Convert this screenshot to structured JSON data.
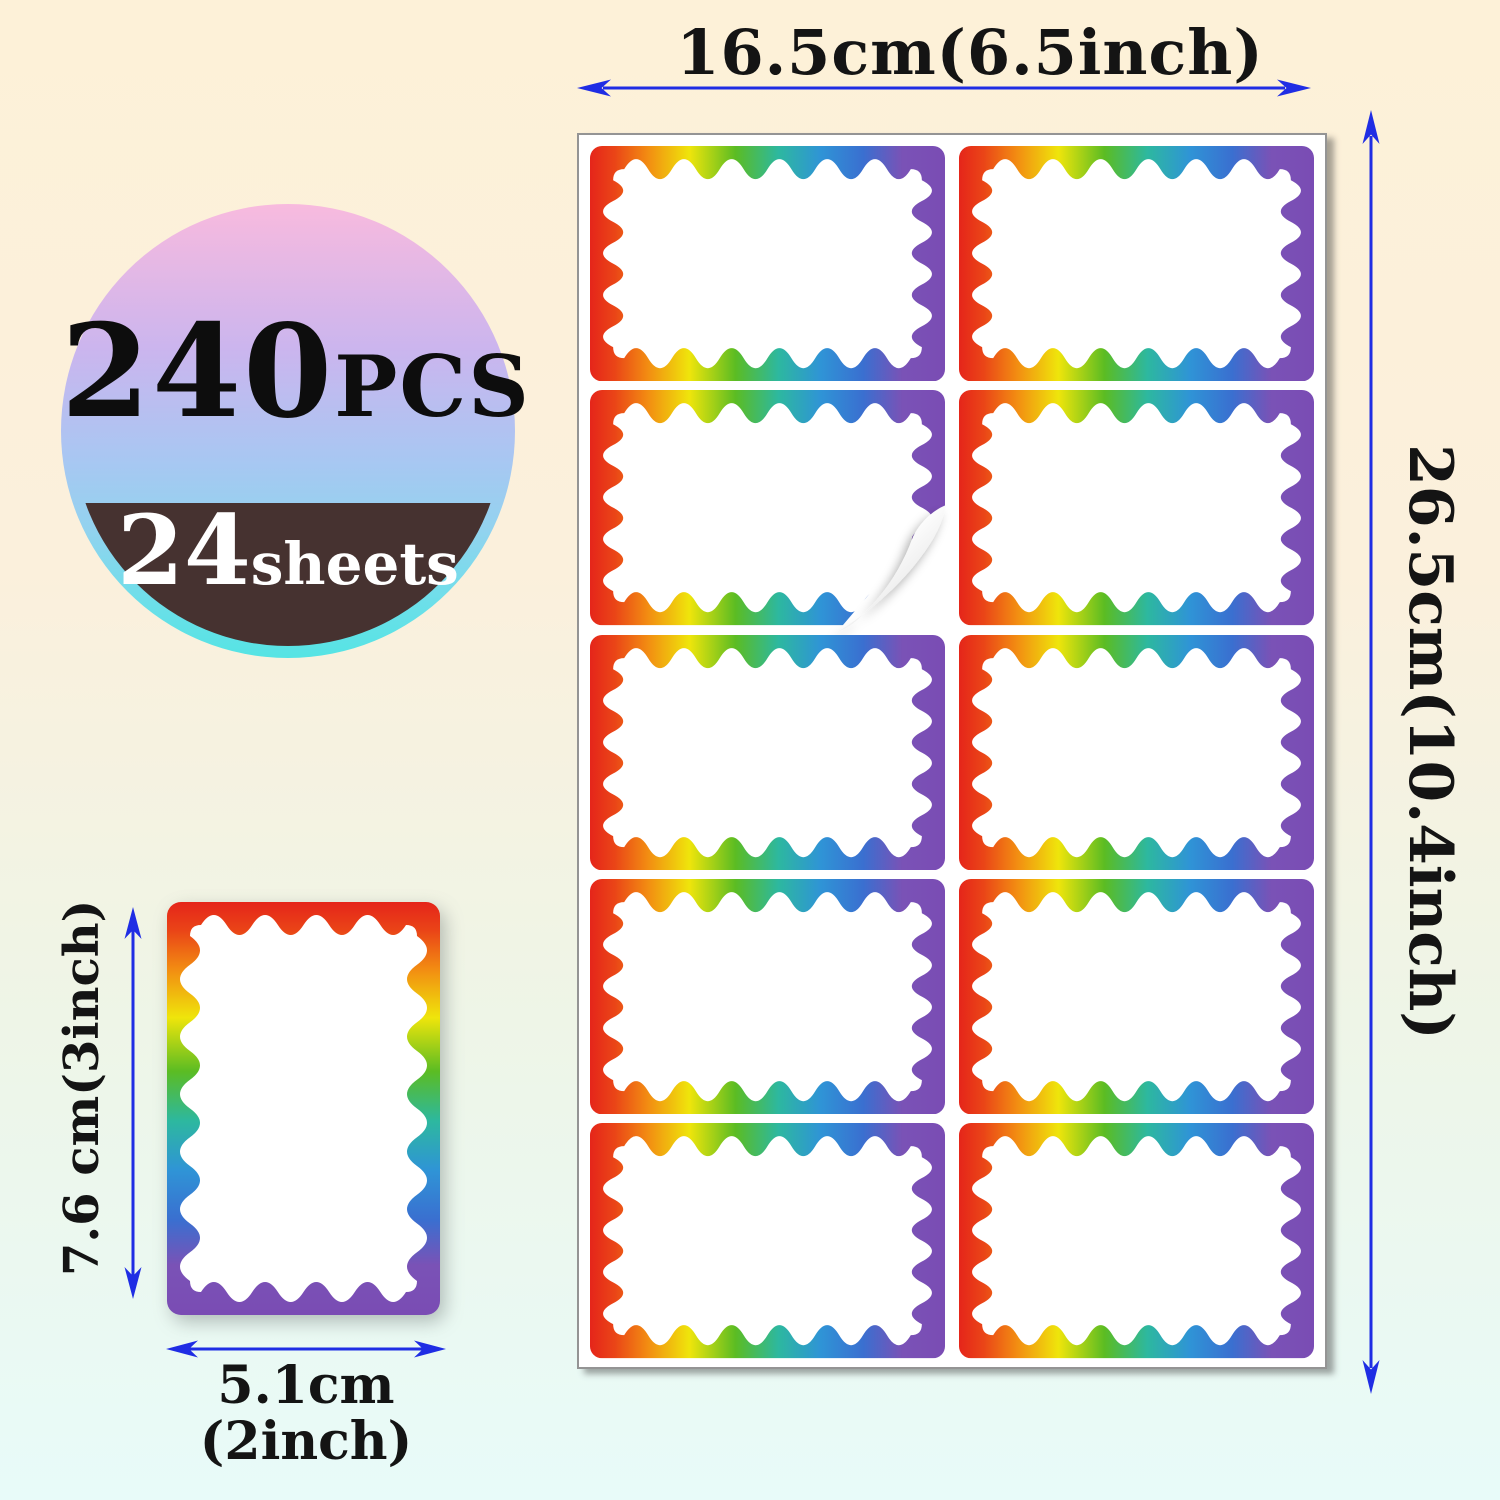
{
  "badge": {
    "count": "240",
    "count_unit": "PCS",
    "sheets_count": "24",
    "sheets_unit": "sheets"
  },
  "dimensions": {
    "sheet_width": "16.5cm(6.5inch)",
    "sheet_height": "26.5cm(10.4inch)",
    "label_height": "7.6 cm(3inch)",
    "label_width_line1": "5.1cm",
    "label_width_line2": "(2inch)"
  },
  "sheet": {
    "rows": 5,
    "cols": 2,
    "label_count": 10,
    "peeling_label_index": 2
  },
  "colors": {
    "arrow_blue": "#1f2de4",
    "badge_brown": "#463230",
    "badge_gradient": [
      "#f8bade",
      "#cbb5ee",
      "#aac6f2",
      "#92d3ef",
      "#55e4e4"
    ],
    "rainbow_border": [
      "#e5251a",
      "#f28a12",
      "#efe50b",
      "#5bbc23",
      "#2db89f",
      "#2f94d6",
      "#7a52b6"
    ],
    "background_top": "#fdf1d8",
    "background_bottom": "#e8fbf9"
  }
}
